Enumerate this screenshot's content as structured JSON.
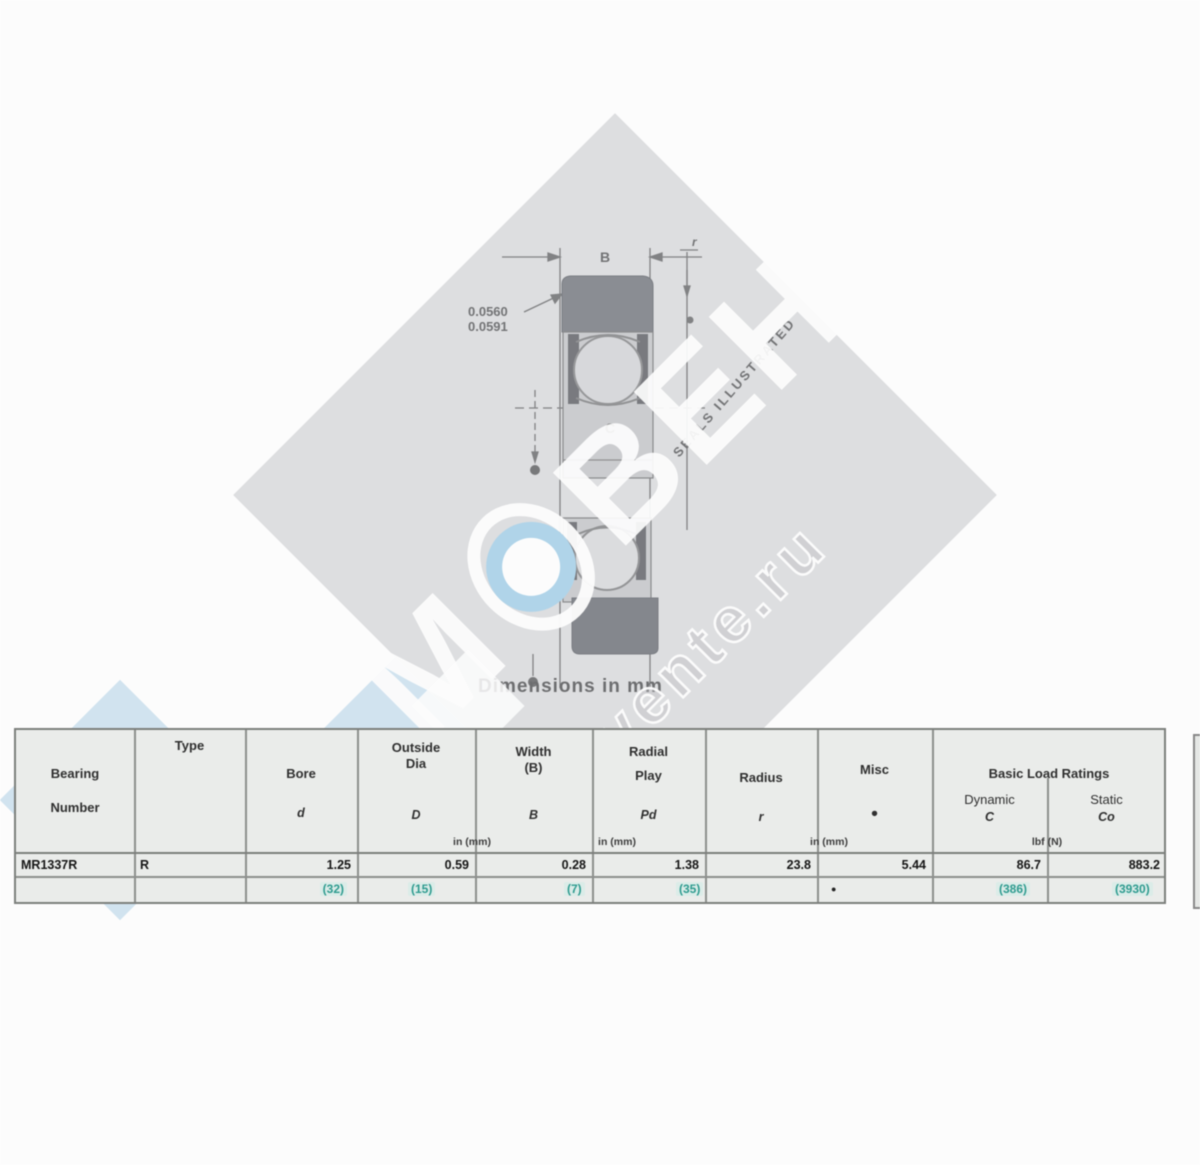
{
  "watermark": {
    "brand_m": "М",
    "brand_rest": "ВЕНТ",
    "brand_m2": "М",
    "site": "movente.ru"
  },
  "drawing": {
    "dim_width_label": "B",
    "dim_corner_label": "r",
    "dim_inner_label": "C",
    "callout_line1": "0.0560",
    "callout_line2": "0.0591",
    "diagonal_note": "SEALS ILLUSTRATED",
    "caption": "Dimensions in mm"
  },
  "table": {
    "col1_header_line1": "Bearing",
    "col1_header_line2": "Number",
    "col2_header": "Type",
    "col3_header": "Bore",
    "col3_symbol": "d",
    "col4_header_line1": "Outside",
    "col4_header_line2": "Dia",
    "col4_symbol": "D",
    "col5_header_line1": "Width",
    "col5_header_line2": "(B)",
    "col5_symbol": "B",
    "col6_header_line1": "Radial",
    "col6_header_line2": "Play",
    "col6_symbol": "Pd",
    "col7_header": "Radius",
    "col7_symbol": "r",
    "col8_header": "Misc",
    "col8_symbol": "●",
    "col9_header": "Basic Load Ratings",
    "col9a_sub": "Dynamic",
    "col9a_symbol": "C",
    "col9b_sub": "Static",
    "col9b_symbol": "Co",
    "unit_note_left": "in (mm)",
    "unit_note_mid": "in (mm)",
    "unit_note_right": "in (mm)",
    "unit_note_load": "lbf (N)",
    "row": {
      "number": "MR1337R",
      "type": "R",
      "bore": "1.25",
      "bore_mm": "(32)",
      "od": "0.59",
      "od_mm": "(15)",
      "width": "0.28",
      "width_mm": "(7)",
      "play": "1.38",
      "play_mm": "(35)",
      "radius": "23.8",
      "radius_mark": "●",
      "misc": "5.44",
      "dynamic": "86.7",
      "dynamic_n": "(386)",
      "static": "883.2",
      "static_n": "(3930)"
    }
  }
}
